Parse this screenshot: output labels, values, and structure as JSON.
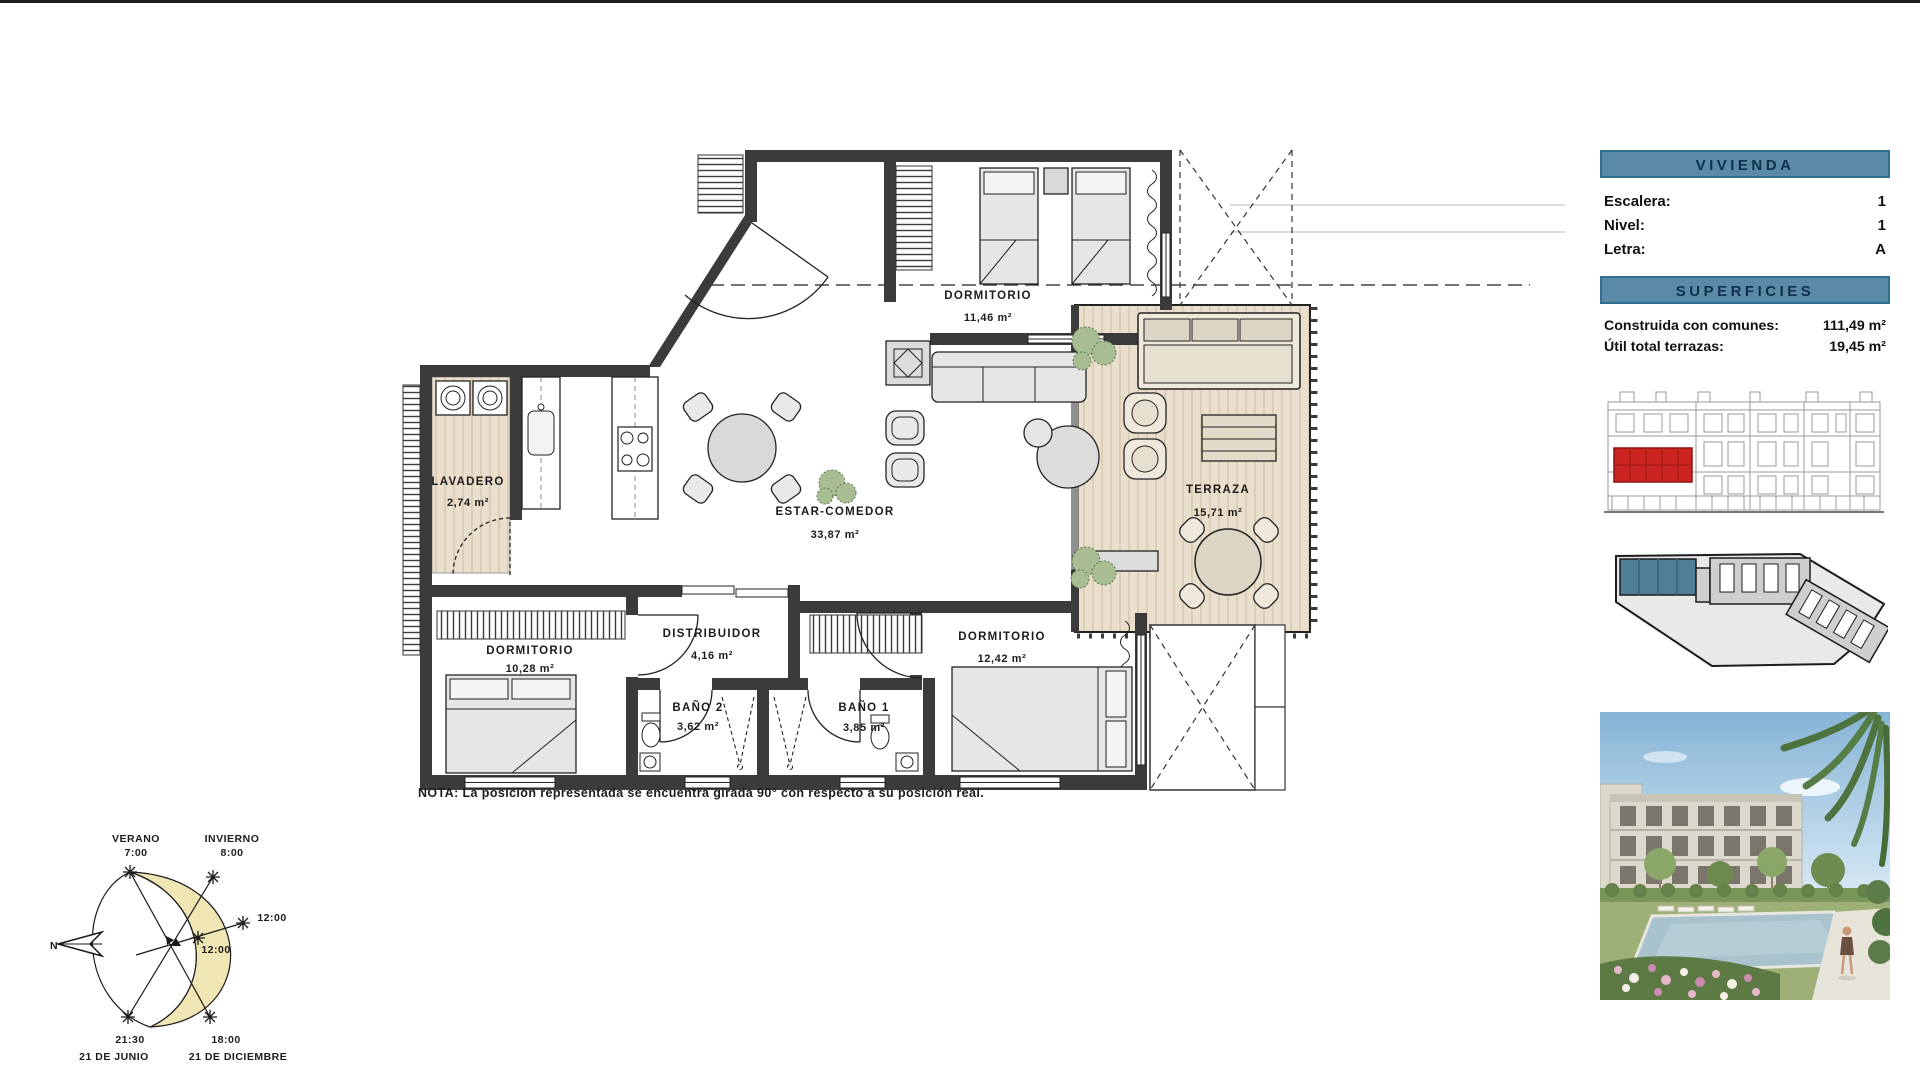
{
  "plan": {
    "note": "NOTA: La posición representada se encuentra girada 90° con respecto a su posición real.",
    "rooms": {
      "dormitorio_top": {
        "name": "DORMITORIO",
        "area": "11,46 m²"
      },
      "lavadero": {
        "name": "LAVADERO",
        "area": "2,74 m²"
      },
      "estar_comedor": {
        "name": "ESTAR-COMEDOR",
        "area": "33,87 m²"
      },
      "terraza": {
        "name": "TERRAZA",
        "area": "15,71 m²"
      },
      "dormitorio_izq": {
        "name": "DORMITORIO",
        "area": "10,28 m²"
      },
      "distribuidor": {
        "name": "DISTRIBUIDOR",
        "area": "4,16 m²"
      },
      "dormitorio_der": {
        "name": "DORMITORIO",
        "area": "12,42 m²"
      },
      "bano2": {
        "name": "BAÑO 2",
        "area": "3,62 m²"
      },
      "bano1": {
        "name": "BAÑO 1",
        "area": "3,85 m²"
      }
    }
  },
  "sidebar": {
    "vivienda": {
      "title": "VIVIENDA",
      "rows": [
        {
          "label": "Escalera:",
          "value": "1"
        },
        {
          "label": "Nivel:",
          "value": "1"
        },
        {
          "label": "Letra:",
          "value": "A"
        }
      ]
    },
    "superficies": {
      "title": "SUPERFICIES",
      "rows": [
        {
          "label": "Construida con comunes:",
          "value": "111,49 m²"
        },
        {
          "label": "Útil total terrazas:",
          "value": "19,45 m²"
        }
      ]
    }
  },
  "sun": {
    "verano": "VERANO",
    "verano_time": "7:00",
    "invierno": "INVIERNO",
    "invierno_time": "8:00",
    "noon_outer": "12:00",
    "noon_inner": "12:00",
    "north": "N",
    "summer_set_time": "21:30",
    "summer_set_date": "21 DE JUNIO",
    "winter_set_time": "18:00",
    "winter_set_date": "21 DE DICIEMBRE"
  },
  "colors": {
    "header_teal": "#5A8AA5",
    "header_text": "#0F3050",
    "highlight_red": "#CC2420",
    "site_teal": "#4E7F97",
    "sun_yellow": "#F0E6B4",
    "wall": "#3B3B3B",
    "wood": "#E9DFCC"
  }
}
